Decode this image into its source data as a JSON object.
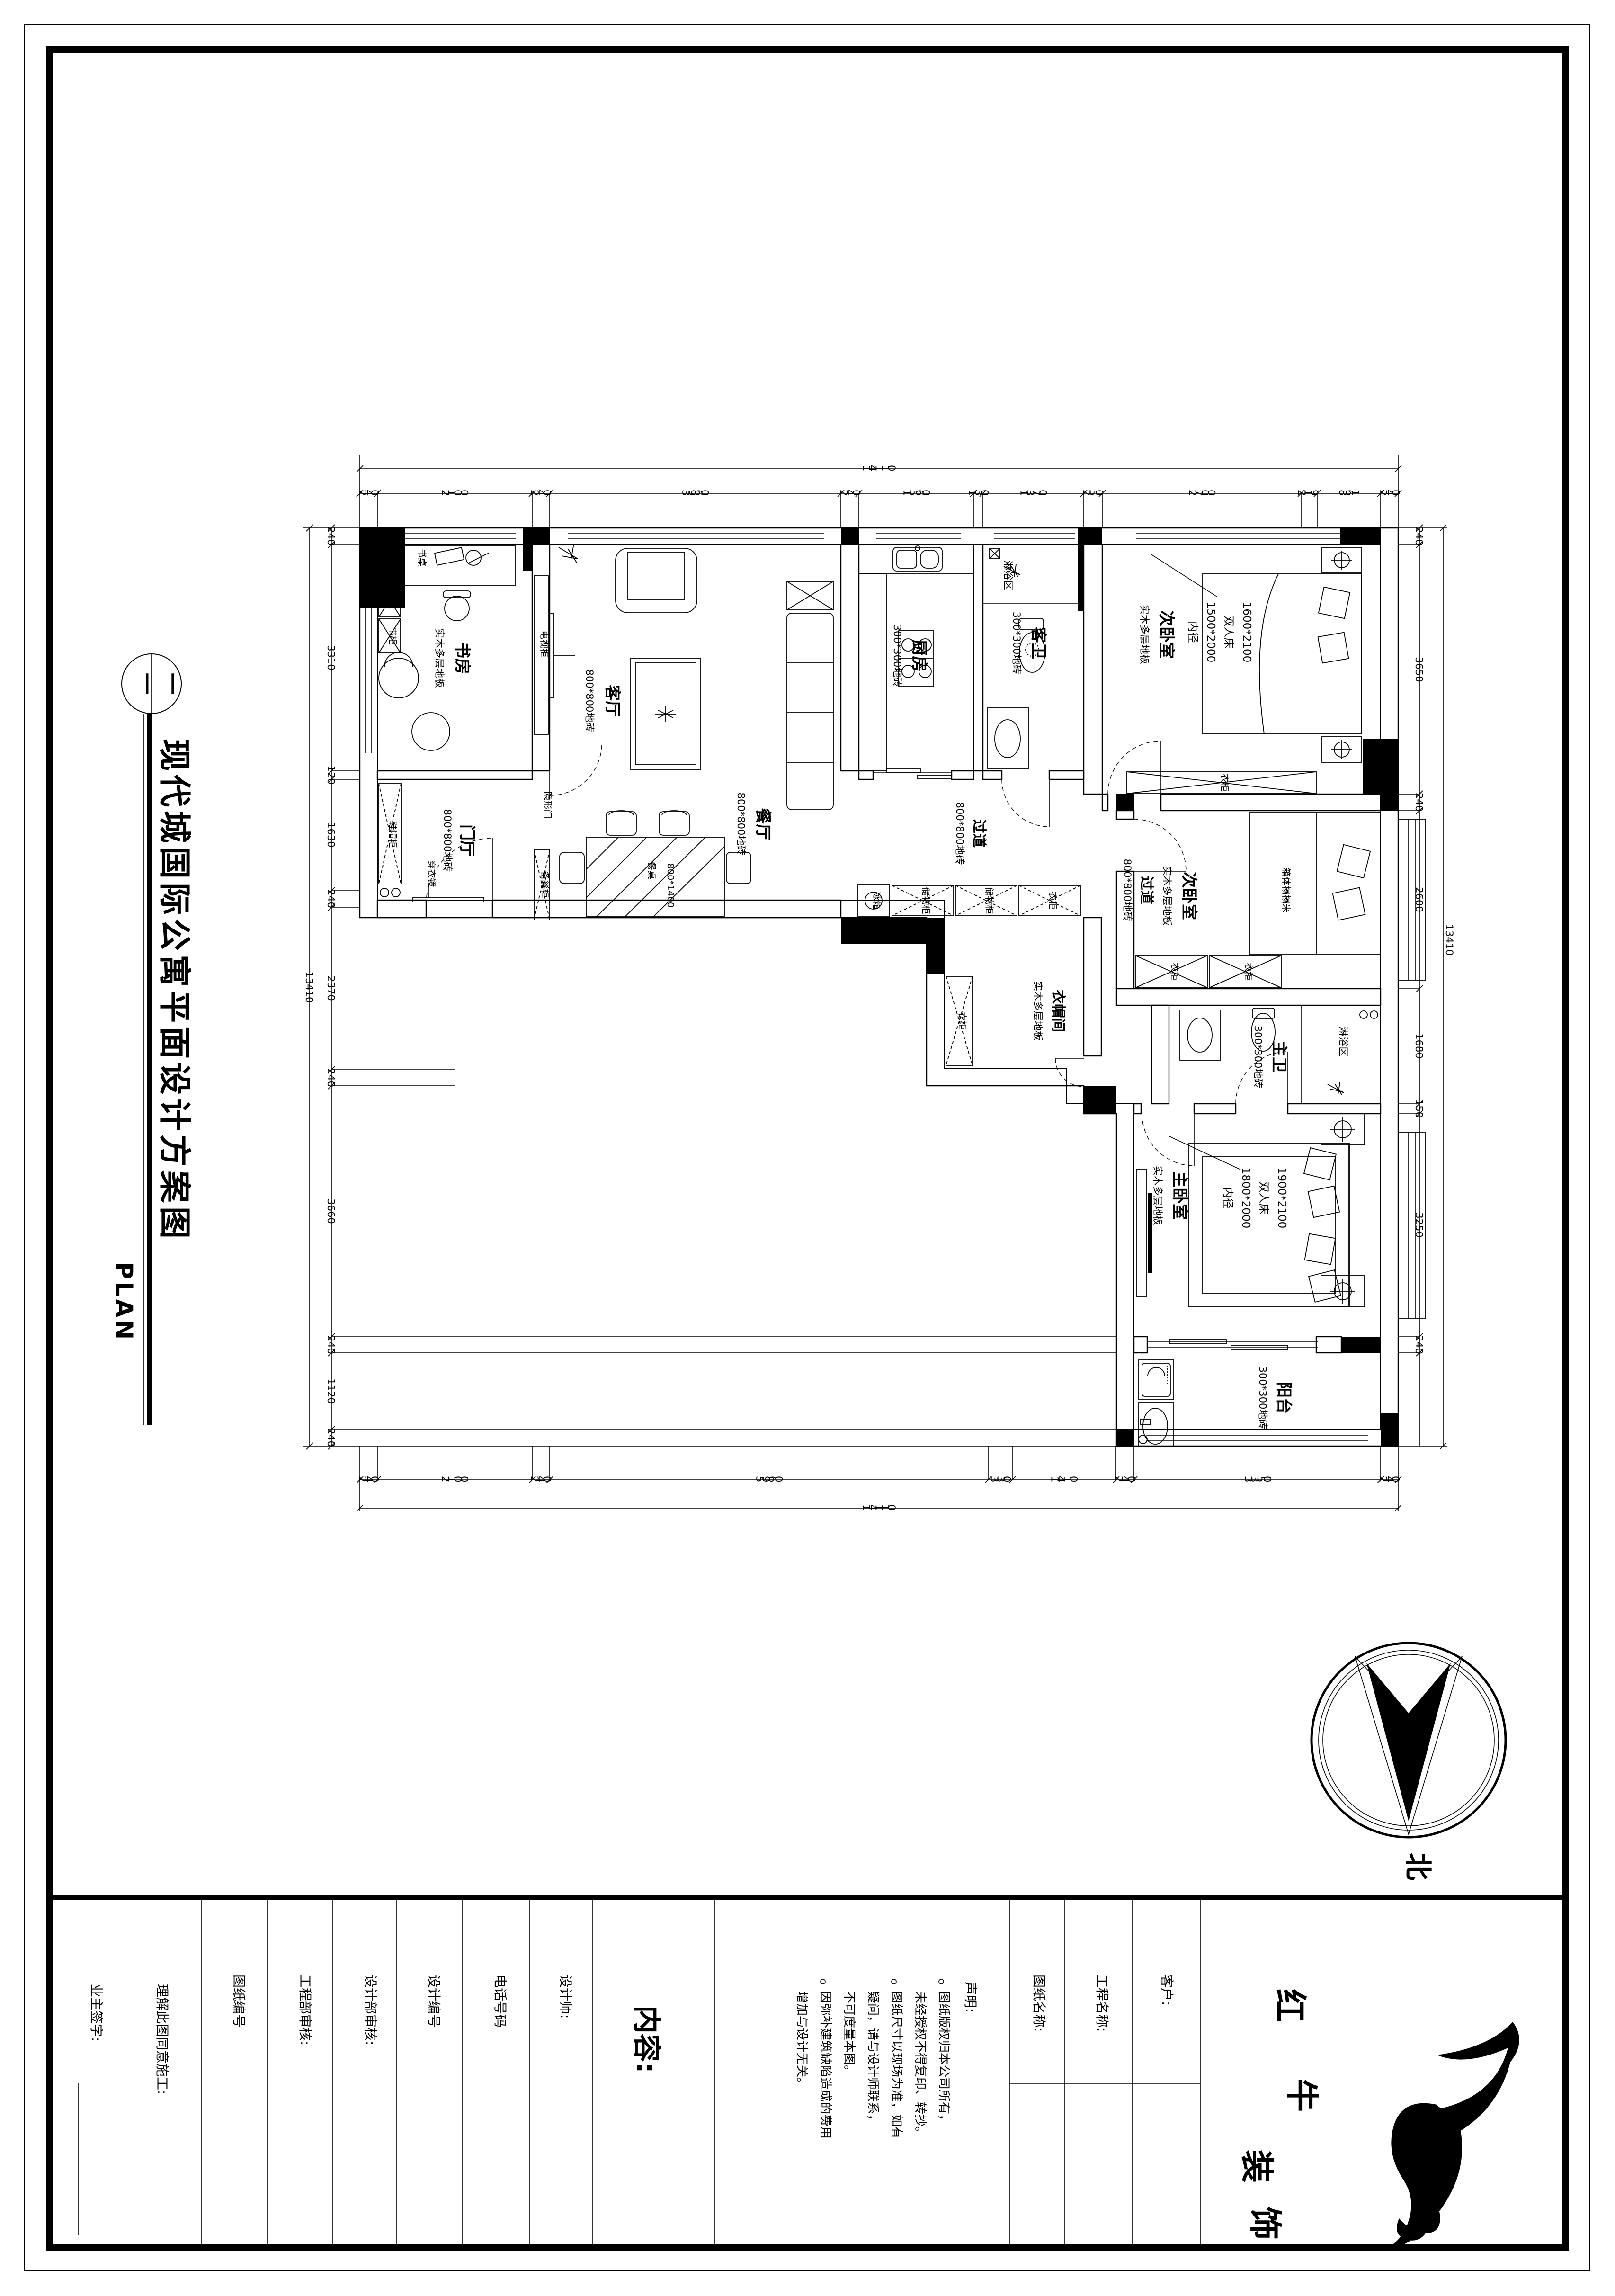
{
  "doc": {
    "background": "#ffffff",
    "ink": "#000000"
  },
  "title": {
    "main": "现代城国际公寓平面设计方案图",
    "sub": "PLAN",
    "bubble_left": "一",
    "bubble_right": "一"
  },
  "north": {
    "label": "北"
  },
  "dims": {
    "top": {
      "overall": "14110",
      "segs": [
        "240",
        "2100",
        "240",
        "3960",
        "240",
        "1560",
        "130",
        "1370",
        "250",
        "2700",
        "219",
        "861",
        "240"
      ]
    },
    "bottom": {
      "overall": "14110",
      "segs": [
        "240",
        "2100",
        "240",
        "5960",
        "330",
        "1410",
        "240",
        "3350",
        "240"
      ]
    },
    "left": {
      "overall": "13410",
      "segs": [
        "240",
        "3310",
        "120",
        "1630",
        "240",
        "2370",
        "240",
        "3660",
        "240",
        "1120",
        "240"
      ]
    },
    "right": {
      "overall": "13410",
      "segs": [
        "240",
        "3650",
        "240",
        "2600",
        "1680",
        "150",
        "3250",
        "240"
      ]
    }
  },
  "rooms": {
    "study": {
      "name": "书房",
      "floor": "实木多层地板"
    },
    "foyer": {
      "name": "门厅",
      "floor": "800*800地砖"
    },
    "living": {
      "name": "客厅",
      "floor": "800*800地砖"
    },
    "dining": {
      "name": "餐厅",
      "floor": "800*800地砖"
    },
    "kitchen": {
      "name": "厨房",
      "floor": "300*300地砖"
    },
    "guest_bath": {
      "name": "客卫",
      "floor": "300*300地砖"
    },
    "corridor": {
      "name": "过道",
      "floor": "800*800地砖"
    },
    "bedroom2": {
      "name": "次卧室",
      "floor": "实木多层地板"
    },
    "cloakroom": {
      "name": "衣帽间",
      "floor": "实木多层地板"
    },
    "master_bath": {
      "name": "主卫",
      "floor": "300*300地砖"
    },
    "master_bed": {
      "name": "主卧室",
      "floor": "实木多层地板"
    },
    "balcony": {
      "name": "阳台",
      "floor": "300*300地砖"
    },
    "shower_zone": "淋浴区"
  },
  "furniture": {
    "bookcase": "书柜",
    "desk": "书桌",
    "tv_cabinet": "电视柜",
    "hidden_door": "隐形门",
    "mirror": "穿衣镜",
    "shoe_cabinet": "鞋帽柜",
    "sideboard": "备餐柜",
    "dining_table": "餐桌",
    "dining_table_size": "800*1400",
    "fridge": "冰箱",
    "storage": "储物柜",
    "wardrobe": "衣柜",
    "tatami": "箱体榻榻米"
  },
  "beds": {
    "second": [
      "1600*2100",
      "双人床",
      "1500*2000",
      "内径"
    ],
    "master": [
      "1900*2100",
      "双人床",
      "1800*2000",
      "内径"
    ]
  },
  "titleblock": {
    "owner_sign": "业主签字:",
    "agree": "理解此图同意施工:",
    "drawing_no": "图纸编号",
    "eng_review": "工程部审核:",
    "design_review": "设计部审核:",
    "design_no": "设计编号",
    "phone": "电话号码",
    "designer": "设计师:",
    "content": "内容:",
    "statement_title": "声明:",
    "statement": [
      "图纸版权归本公司所有，",
      "未经授权不得复印、转抄。",
      "图纸尺寸以现场为准，如有",
      "疑问，请与设计师联系，",
      "不可度量本图。",
      "因弥补建筑缺陷造成的费用",
      "增加与设计无关。"
    ],
    "drawing_name": "图纸名称:",
    "project_name": "工程名称:",
    "client": "客户:",
    "brand": [
      "红",
      "牛",
      "装",
      "饰"
    ]
  }
}
